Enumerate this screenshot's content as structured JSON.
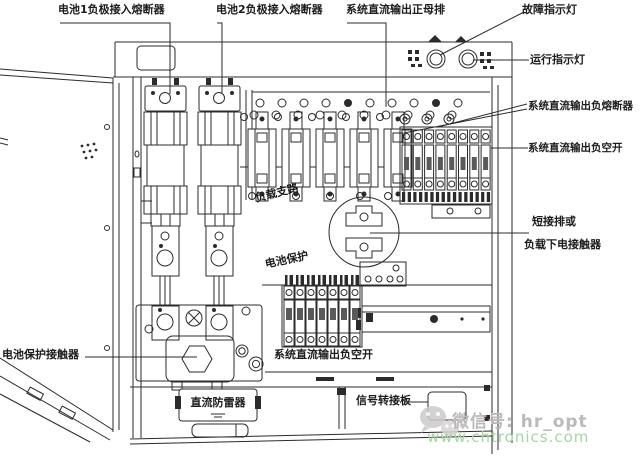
{
  "diagram_title": "DC power distribution cabinet internal layout",
  "labels": {
    "battery1_fuse": "电池1负极接入熔断器",
    "battery2_fuse": "电池2负极接入熔断器",
    "positive_busbar": "系统直流输出正母排",
    "fault_lamp": "故障指示灯",
    "run_lamp": "运行指示灯",
    "neg_fuse": "系统直流输出负熔断器",
    "neg_breaker_right": "系统直流输出负空开",
    "short_bar_1": "短接排或",
    "short_bar_2": "负载下电接触器",
    "battery_contactor": "电池保护接触器",
    "load_branch": "负载支路",
    "battery_protect": "电池保护",
    "dc_arrester": "直流防雷器",
    "neg_breaker_bottom": "系统直流输出负空开",
    "signal_board": "信号转接板"
  },
  "watermark": {
    "wechat_id": "微信号: hr_opt",
    "website": "www.chtronics.com",
    "wechat_color": "#bcb9b9",
    "website_color": "#a5d6a0"
  },
  "colors": {
    "line": "#2b2b2b",
    "background": "#ffffff"
  }
}
